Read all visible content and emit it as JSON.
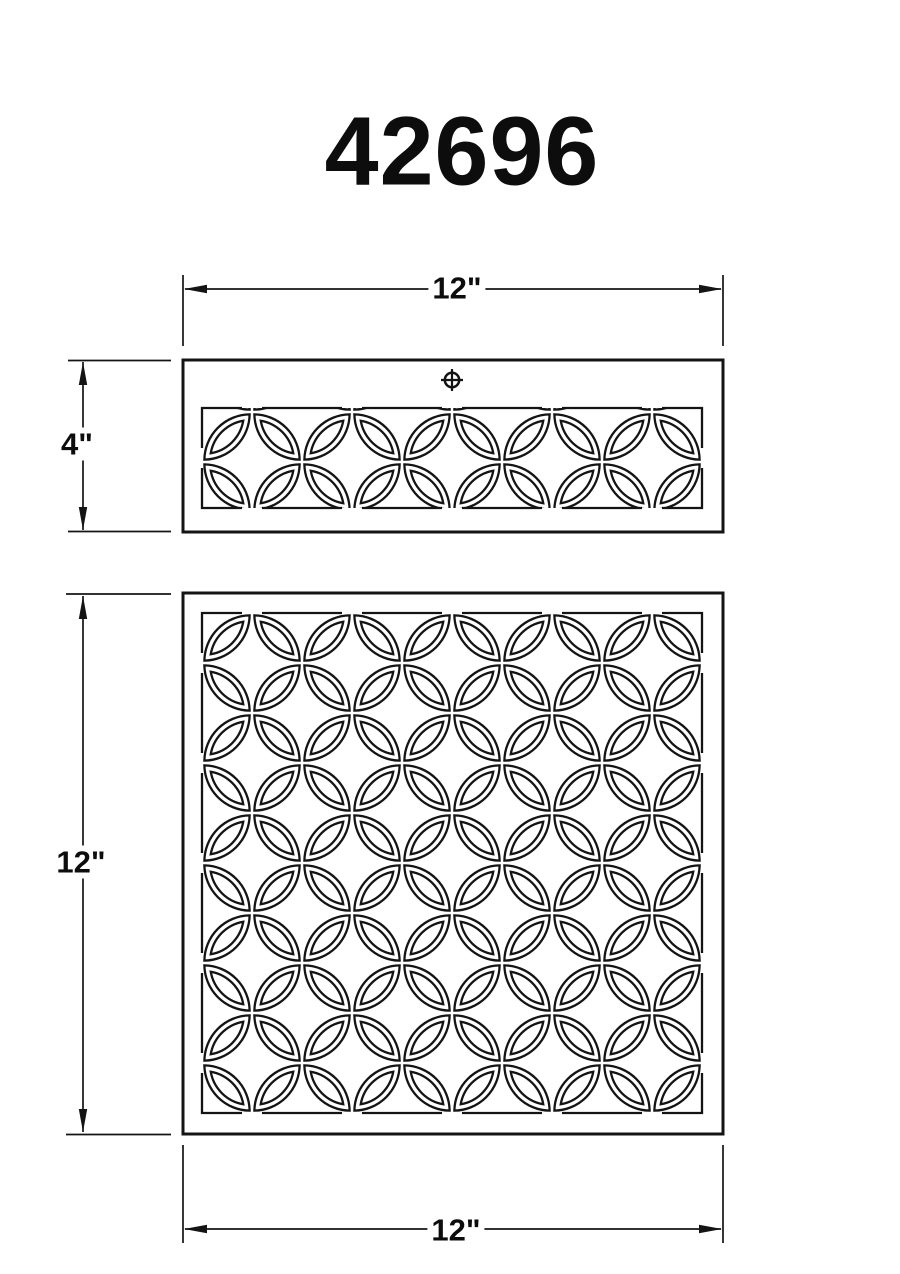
{
  "title": "42696",
  "drawing": {
    "line_color": "#141414",
    "background": "#ffffff",
    "pattern_name": "interlocking-circles-lattice"
  },
  "top_view": {
    "name": "top view",
    "width_dim": "12\"",
    "height_dim": "4\"",
    "center_mark_icon": "crosshair-circle"
  },
  "front_view": {
    "name": "front view",
    "width_dim": "12\"",
    "height_dim": "12\""
  }
}
